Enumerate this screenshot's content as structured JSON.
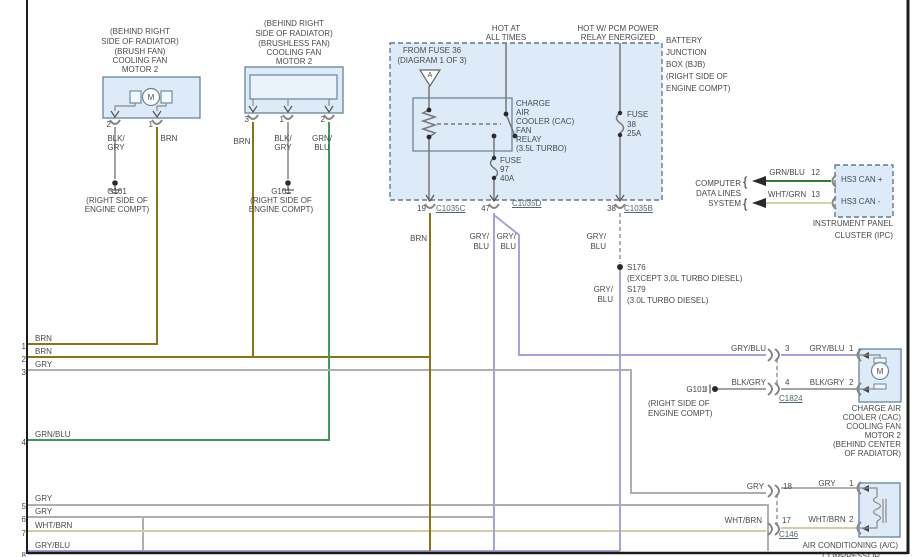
{
  "colors": {
    "brn": "#8f7312",
    "gry": "#b0afad",
    "blkgry": "#a3a3a3",
    "grnblu": "#3f9b58",
    "cangrn": "#2f8132",
    "gryblu": "#a3a3e0",
    "whtbrn": "#d8cba1",
    "whtgrn": "#c6db9c",
    "fill": "#dcebf7",
    "box": "#64859b",
    "dashbox": "#5f7d8e",
    "border": "#1c1c1c"
  },
  "rows": [
    {
      "n": "1",
      "label": "BRN"
    },
    {
      "n": "2",
      "label": "BRN"
    },
    {
      "n": "3",
      "label": "GRY"
    },
    {
      "n": "4",
      "label": "GRN/BLU"
    },
    {
      "n": "5",
      "label": "GRY"
    },
    {
      "n": "6",
      "label": "GRY"
    },
    {
      "n": "7",
      "label": "WHT/BRN"
    },
    {
      "n": "8",
      "label": "GRY/BLU"
    }
  ],
  "brush_fan": {
    "title": [
      "(BEHIND RIGHT",
      "SIDE OF RADIATOR)",
      "(BRUSH FAN)",
      "COOLING FAN",
      "MOTOR 2"
    ],
    "motor": "M",
    "pin2": "2",
    "pin1": "1",
    "w2a": "BLK/",
    "w2b": "GRY",
    "w1": "BRN"
  },
  "brushless_fan": {
    "title": [
      "(BEHIND RIGHT",
      "SIDE OF RADIATOR)",
      "(BRUSHLESS FAN)",
      "COOLING FAN",
      "MOTOR 2"
    ],
    "pin3": "3",
    "pin1": "1",
    "pin2": "2",
    "w3": "BRN",
    "w1a": "BLK/",
    "w1b": "GRY",
    "w2a": "GRN/",
    "w2b": "BLU"
  },
  "ground_left": {
    "id": "G101",
    "l1": "(RIGHT SIDE OF",
    "l2": "ENGINE COMPT)"
  },
  "ground_mid": {
    "id": "G101",
    "l1": "(RIGHT SIDE OF",
    "l2": "ENGINE COMPT)"
  },
  "ground_right": {
    "id": "G101",
    "l1": "(RIGHT SIDE OF",
    "l2": "ENGINE COMPT)"
  },
  "bjb": {
    "hot1a": "HOT AT",
    "hot1b": "ALL TIMES",
    "hot2a": "HOT W/ PCM POWER",
    "hot2b": "RELAY ENERGIZED",
    "from_fuse1": "FROM FUSE 36",
    "from_fuse2": "(DIAGRAM 1 OF 3)",
    "tri": "A",
    "relay": [
      "CHARGE",
      "AIR",
      "COOLER (CAC)",
      "FAN",
      "RELAY",
      "(3.5L TURBO)"
    ],
    "fuse97": [
      "FUSE",
      "97",
      "40A"
    ],
    "fuse38": [
      "FUSE",
      "38",
      "25A"
    ],
    "title": [
      "BATTERY",
      "JUNCTION",
      "BOX (BJB)",
      "(RIGHT SIDE OF",
      "ENGINE COMPT)"
    ],
    "p19": "19",
    "c19": "C1035C",
    "p47": "47",
    "c47": "C1035D",
    "p38": "38",
    "c38": "C1035B"
  },
  "seg": {
    "brn": "BRN",
    "gry_blu_a": "GRY/",
    "gry_blu_b": "BLU"
  },
  "splice": {
    "s1": "S176",
    "s1_note": "(EXCEPT 3.0L TURBO DIESEL)",
    "s2": "S179",
    "s2_note": "(3.0L TURBO DIESEL)"
  },
  "data_lines": {
    "label": [
      "COMPUTER",
      "DATA LINES",
      "SYSTEM"
    ],
    "brace": "{",
    "rows": [
      {
        "wire": "GRN/BLU",
        "pin": "12",
        "name": "HS3 CAN +"
      },
      {
        "wire": "WHT/GRN",
        "pin": "13",
        "name": "HS3 CAN -"
      }
    ],
    "module1": "INSTRUMENT PANEL",
    "module2": "CLUSTER (IPC)"
  },
  "cac": {
    "rows": [
      {
        "left": "GRY/BLU",
        "pout": "3",
        "right": "GRY/BLU",
        "pin": "1"
      },
      {
        "left": "BLK/GRY",
        "pout": "4",
        "right": "BLK/GRY",
        "pin": "2"
      }
    ],
    "conn": "C1824",
    "motor": "M",
    "name": [
      "CHARGE AIR",
      "COOLER (CAC)",
      "COOLING FAN",
      "MOTOR 2",
      "(BEHIND CENTER",
      "OF RADIATOR)"
    ]
  },
  "ac": {
    "rows": [
      {
        "left": "GRY",
        "pout": "18",
        "right": "GRY",
        "pin": "1"
      },
      {
        "left": "WHT/BRN",
        "pout": "17",
        "right": "WHT/BRN",
        "pin": "2"
      }
    ],
    "conn": "C146",
    "name1": "AIR CONDITIONING (A/C)",
    "name2": "COMPRESSOR"
  }
}
